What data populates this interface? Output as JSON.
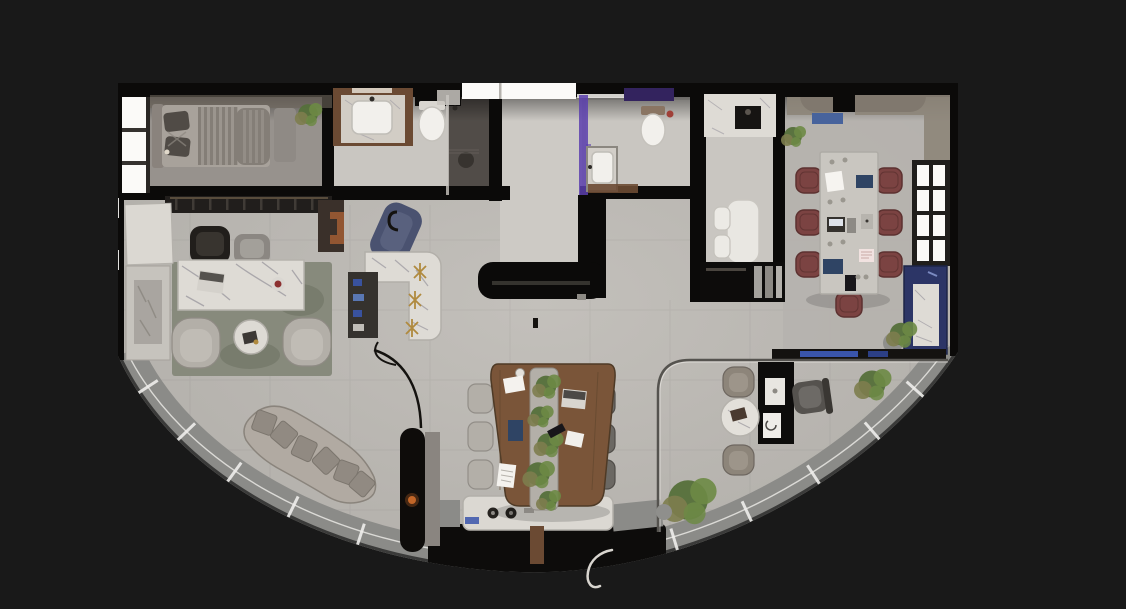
{
  "scene": {
    "kind": "3d-floor-plan-top-down-render",
    "shape": "fan-shaped plan, straight top wall, curved glazed south wall"
  },
  "rooms": [
    {
      "name": "bedroom",
      "items": [
        "bed",
        "striped-duvet",
        "pillows",
        "headboard",
        "side-bench",
        "window-strip",
        "plant"
      ]
    },
    {
      "name": "bathroom-1",
      "items": [
        "wood-vanity",
        "white-sink",
        "toilet",
        "walk-in-shower",
        "shower-stool"
      ]
    },
    {
      "name": "entry-hall",
      "items": [
        "skylight",
        "black-console"
      ]
    },
    {
      "name": "bathroom-2",
      "items": [
        "toilet",
        "sink",
        "purple-accent-light",
        "wood-mat"
      ]
    },
    {
      "name": "kitchenette",
      "items": [
        "marble-counter",
        "cooktop",
        "breakfast-table",
        "two-white-chairs",
        "black-cabinet"
      ]
    },
    {
      "name": "meeting-room",
      "items": [
        "long-table",
        "seven-burgundy-chairs",
        "paned-window",
        "blue-sideboard",
        "marble-slab",
        "plants",
        "book-ledge"
      ]
    },
    {
      "name": "executive-office",
      "items": [
        "marble-desk",
        "laptop",
        "executive-chair",
        "guest-chair",
        "area-rug",
        "two-armchairs",
        "round-side-table",
        "stone-console",
        "leaning-board"
      ]
    },
    {
      "name": "bar-lounge",
      "items": [
        "l-shaped-marble-bar",
        "gold-stools",
        "navy-chaise",
        "drinks-shelf"
      ]
    },
    {
      "name": "team-table",
      "items": [
        "organic-wood-table",
        "center-planter",
        "pendant-lamp",
        "three-light-chairs",
        "three-dark-chairs",
        "laptop",
        "papers"
      ]
    },
    {
      "name": "workstation",
      "items": [
        "black-desk",
        "printer",
        "task-chair",
        "round-marble-table",
        "two-taupe-chairs"
      ]
    },
    {
      "name": "lounge",
      "items": [
        "curved-sofa",
        "six-pillows",
        "fireplace-column",
        "arc-floor-lamp"
      ]
    },
    {
      "name": "curved-window-wall",
      "items": [
        "glazing-sill-panels",
        "white-dividers",
        "sill-console-with-knobs",
        "balcony-void",
        "potted-plants",
        "door-swing-squiggle"
      ]
    }
  ],
  "colors": {
    "bg": "#191919",
    "wall": "#0b0a09",
    "floor": "#b6b3ae",
    "floorLight": "#c9c6c1",
    "floorDark": "#a19d98",
    "bedroomFloor": "#97928d",
    "corridor": "#cdcac5",
    "white": "#f2f0ec",
    "glow": "#fbfaf8",
    "marble": "#dedbd5",
    "vein": "#98959c",
    "rug": "#878a7c",
    "rugDark": "#666a5c",
    "bedBase": "#a8a29b",
    "bedStripeA": "#9b958e",
    "bedStripeB": "#847e77",
    "pillow": "#504b46",
    "headboard": "#8a837d",
    "chairLight": "#b3afa8",
    "chairTaupe": "#8d857a",
    "chairDark": "#6b6863",
    "execChair": "#211e1b",
    "maroon": "#7b4342",
    "maroonDark": "#5c3130",
    "confTable": "#c9c6c0",
    "wood": "#7a5539",
    "woodDark": "#57402a",
    "planter": "#b3afa8",
    "plantA": "#6d8a45",
    "plantB": "#55703a",
    "plantC": "#7d7d4e",
    "blue": "#2c3566",
    "blueBright": "#3a55ab",
    "purple": "#5c3fae",
    "purpleDark": "#33235e",
    "gold": "#b08a3e",
    "sofa": "#b1aaa2",
    "sofaPillow": "#918a82",
    "sill": "#8b8b88",
    "sillLine": "#f0efec",
    "glass": "#55534f",
    "sky": "#47639c",
    "tan": "#8d8579",
    "brown": "#6b4a33",
    "cooktop": "#161412",
    "blackUnit": "#0d0c0b",
    "ember": "#c96a2a"
  }
}
